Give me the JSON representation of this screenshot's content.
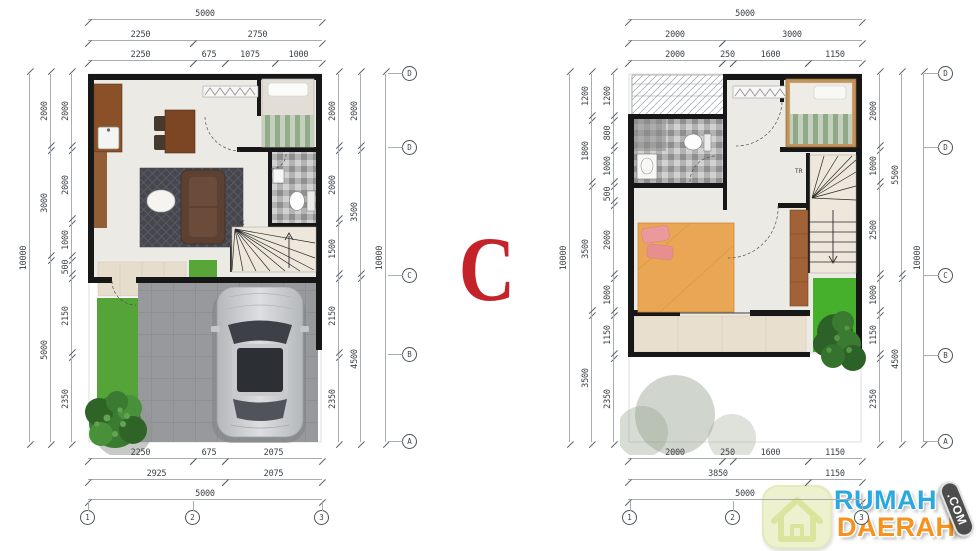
{
  "center_label": "C",
  "colors": {
    "wall": "#171717",
    "dimension_text": "#3d4247",
    "letter_c_red": "#c4232a",
    "logo_blue": "#2aa9e0",
    "logo_orange": "#f6921e",
    "grass_green": "#55a437"
  },
  "logo": {
    "word1": "RUMAH",
    "word2": "DAERAH",
    "tld": ".COM"
  },
  "lp": {
    "top": {
      "r1": [
        "5000"
      ],
      "r2": [
        "2250",
        "2750"
      ],
      "r3": [
        "2250",
        "675",
        "1075",
        "1000"
      ]
    },
    "bottom": {
      "r1": [
        "2250",
        "675",
        "2075"
      ],
      "r2": [
        "2925",
        "2075"
      ],
      "r3": [
        "5000"
      ]
    },
    "left": {
      "outer": [
        "10000"
      ],
      "mid": [
        "2000",
        "3000",
        "5000"
      ],
      "inner": [
        "2000",
        "2000",
        "1000",
        "500",
        "2150",
        "2350"
      ]
    },
    "right": {
      "inner": [
        "2000",
        "2000",
        "1500",
        "2150",
        "2350"
      ],
      "mid": [
        "2000",
        "3500",
        "4500"
      ],
      "outer": [
        "10000"
      ]
    },
    "rows": [
      "D",
      "D",
      "C",
      "B",
      "A"
    ],
    "cols": [
      "1",
      "2",
      "3"
    ],
    "stair": "NK"
  },
  "rp": {
    "top": {
      "r1": [
        "5000"
      ],
      "r2": [
        "2000",
        "3000"
      ],
      "r3": [
        "2000",
        "250",
        "1600",
        "1150"
      ]
    },
    "bottom": {
      "r1": [
        "2000",
        "250",
        "1600",
        "1150"
      ],
      "r2": [
        "3850",
        "1150"
      ],
      "r3": [
        "5000"
      ]
    },
    "left": {
      "outer": [
        "10000"
      ],
      "mid": [
        "1200",
        "1800",
        "3500",
        "3500"
      ],
      "inner": [
        "1200",
        "800",
        "1000",
        "500",
        "2000",
        "1000",
        "1150",
        "2350"
      ]
    },
    "right": {
      "inner": [
        "2000",
        "1000",
        "2500",
        "1000",
        "1150",
        "2350"
      ],
      "mid": [
        "5500",
        "4500"
      ],
      "outer": [
        "10000"
      ]
    },
    "rows": [
      "D",
      "D",
      "C",
      "B",
      "A"
    ],
    "cols": [
      "1",
      "2",
      "3"
    ],
    "stair": "TR"
  }
}
